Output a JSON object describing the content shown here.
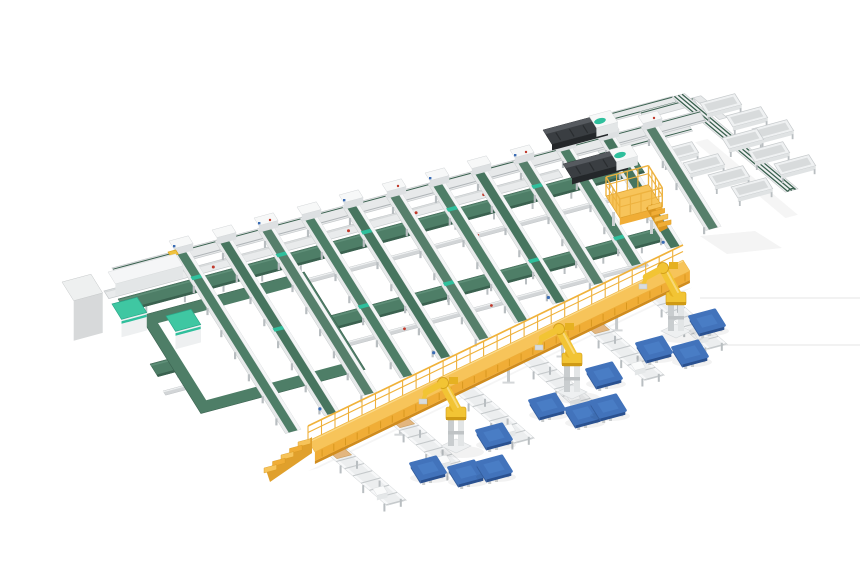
{
  "meta": {
    "description": "Isometric 3D render of an automated panel sorting and palletizing factory line: a lattice of green belt conveyor sorting lanes, cross transfer belts, a return loop, an electrical cabinet with two teal infeed machines, two dark press machines, a yellow operator platform with stairs, a diagonal takeaway conveyor flanked by white sorting bins, a long yellow elevated gantry walkway with a staircase, white outfeed roller tables, three yellow palletizing robots and blue pallets on the floor."
  },
  "palette": {
    "background": "#ffffff",
    "belt_green": "#4e7e67",
    "belt_green_alt": "#47755f",
    "belt_green_light": "#567f6b",
    "belt_green_dark": "#3a614f",
    "teal_accent": "#2fbf9c",
    "teal_top": "#3fc7a2",
    "frame_white": "#f4f5f6",
    "frame_light": "#e7e9ea",
    "frame_mid": "#cdd1d3",
    "frame_dark": "#aab0b3",
    "leg_gray": "#b9bec1",
    "cabinet_gray": "#d7d9da",
    "machine_dark": "#3a3e42",
    "machine_darker": "#24272a",
    "machine_top": "#565a5f",
    "yellow_top": "#f7c45a",
    "yellow_mid": "#f0ad36",
    "yellow_dark": "#d08c1d",
    "robot_yellow": "#f2c434",
    "robot_shade": "#cf9a15",
    "pallet_top": "#4273bb",
    "pallet_light": "#5185cd",
    "pallet_side": "#2a5190",
    "red_dot": "#c0392b",
    "blue_dot": "#3a6cb4",
    "board_tan": "#e3b67f"
  },
  "scene": {
    "projection": {
      "dir_a_deg": -15,
      "dir_b_deg": 58,
      "diag_deg": 40,
      "table_deg": 41
    },
    "floor_marks": {
      "lines": [
        [
          700,
          298,
          860,
          298
        ],
        [
          678,
          345,
          860,
          345
        ]
      ],
      "patch": "700,236 755,231 782,248 727,254"
    },
    "sorting_grid": {
      "spine": {
        "x": 112,
        "y": 268,
        "len": 608,
        "w": 13
      },
      "feed_line": {
        "x": 104,
        "y": 291,
        "len": 470,
        "w": 9,
        "dot_ts": [
          40,
          110,
          180,
          250,
          320,
          390
        ]
      },
      "cross_belts": [
        {
          "x": 118,
          "y": 299,
          "len": 537
        },
        {
          "x": 150,
          "y": 364,
          "len": 532
        }
      ],
      "walkways": [
        {
          "x": 130,
          "y": 326,
          "len": 515,
          "dot_ts": [
            90,
            180,
            270,
            360
          ]
        },
        {
          "x": 163,
          "y": 391,
          "len": 500,
          "dot_ts": [
            70,
            160,
            250,
            340
          ]
        }
      ],
      "lanes": [
        {
          "x": 172,
          "y": 252,
          "len": 214
        },
        {
          "x": 215,
          "y": 241,
          "len": 206
        },
        {
          "x": 257,
          "y": 229,
          "len": 197
        },
        {
          "x": 300,
          "y": 218,
          "len": 189
        },
        {
          "x": 342,
          "y": 206,
          "len": 181
        },
        {
          "x": 385,
          "y": 195,
          "len": 172
        },
        {
          "x": 428,
          "y": 184,
          "len": 164
        },
        {
          "x": 470,
          "y": 172,
          "len": 156
        },
        {
          "x": 513,
          "y": 161,
          "len": 147
        },
        {
          "x": 555,
          "y": 149,
          "len": 139
        },
        {
          "x": 598,
          "y": 138,
          "len": 131
        },
        {
          "x": 641,
          "y": 127,
          "len": 122
        }
      ],
      "return_loop": {
        "tl": [
          140,
          316
        ],
        "len_a": 170,
        "len_b": 115,
        "band": 12,
        "inner": {
          "x": 206,
          "y": 300,
          "len": 76
        }
      },
      "yellow_marker": [
        168,
        252
      ]
    },
    "left_station": {
      "cabinet": {
        "x": 62,
        "y": 282,
        "len_a": 30,
        "len_b": 22,
        "h": 40
      },
      "cover": {
        "x": 108,
        "y": 272,
        "len_a": 70,
        "len_b": 14,
        "h": 12
      },
      "machines": [
        [
          112,
          304
        ],
        [
          166,
          316
        ]
      ]
    },
    "press_machines": [
      [
        543,
        130
      ],
      [
        563,
        164
      ]
    ],
    "operator_platform": {
      "x": 606,
      "y": 196,
      "len_a": 44,
      "len_b": 26,
      "h": 7
    },
    "outfeed_branch": {
      "feeds": [
        {
          "x": 576,
          "y": 122,
          "len": 100
        },
        {
          "x": 596,
          "y": 148,
          "len": 95
        }
      ],
      "top_track": {
        "x": 640,
        "y": 112,
        "len": 55,
        "turn_len": 34
      },
      "diagonal": {
        "x": 672,
        "y": 97,
        "len": 148,
        "w": 13
      },
      "bins_top": [
        [
          700,
          103
        ],
        [
          726,
          116
        ],
        [
          752,
          129
        ]
      ],
      "bins_upper": [
        [
          722,
          138
        ],
        [
          748,
          151
        ],
        [
          774,
          164
        ]
      ],
      "bins_lower": [
        [
          657,
          151
        ],
        [
          683,
          163
        ],
        [
          708,
          175
        ],
        [
          731,
          187
        ]
      ]
    },
    "palletizing": {
      "gantry": {
        "x1": 308,
        "y1": 441,
        "x2": 683,
        "y2": 260,
        "deck_w": 13
      },
      "tables": [
        [
          322,
          449
        ],
        [
          385,
          418
        ],
        [
          450,
          387
        ],
        [
          515,
          355
        ],
        [
          580,
          324
        ],
        [
          643,
          293
        ]
      ],
      "table_len": 86,
      "table_w": 20,
      "boards_on": [
        0,
        1,
        4
      ],
      "robots": [
        [
          456,
          445
        ],
        [
          572,
          391
        ],
        [
          676,
          330
        ]
      ],
      "pallets": [
        [
          428,
          468
        ],
        [
          466,
          472
        ],
        [
          494,
          467
        ],
        [
          494,
          435
        ],
        [
          547,
          405
        ],
        [
          583,
          413
        ],
        [
          608,
          406
        ],
        [
          604,
          374
        ],
        [
          654,
          348
        ],
        [
          690,
          352
        ],
        [
          707,
          321
        ]
      ]
    }
  }
}
